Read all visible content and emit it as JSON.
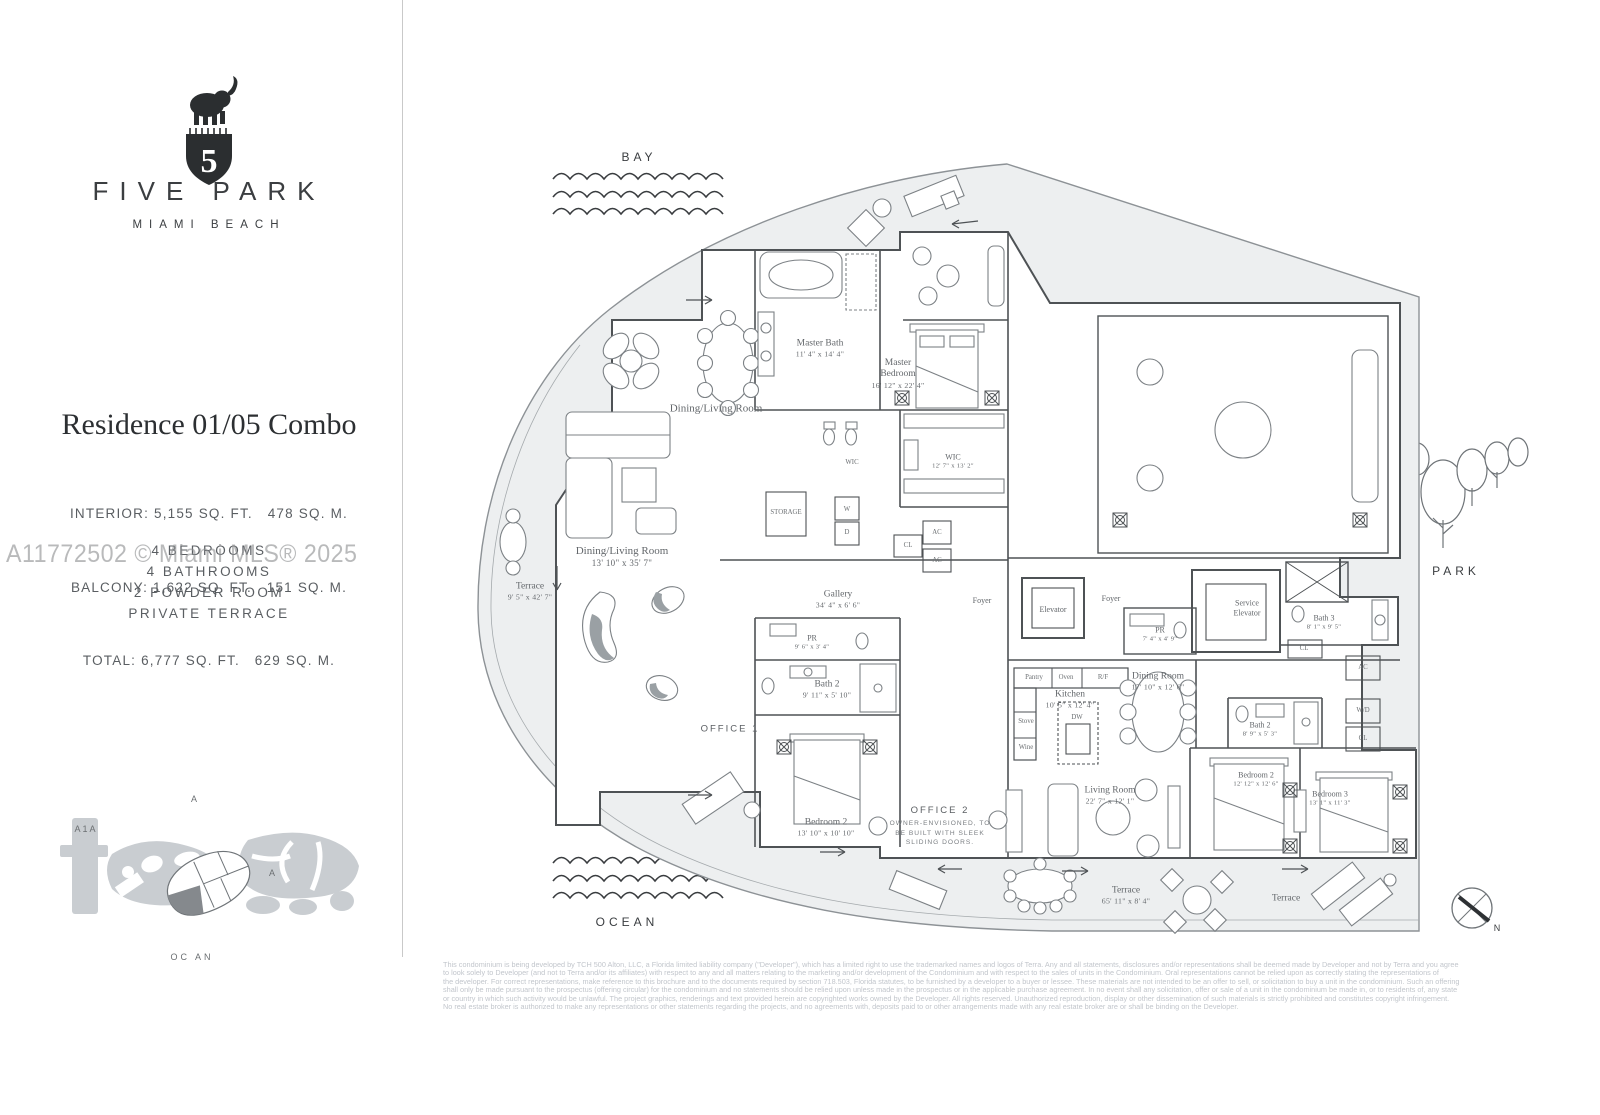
{
  "brand": {
    "logo": "elephant-on-shield-5",
    "name": "FIVE PARK",
    "location": "MIAMI BEACH"
  },
  "residence": {
    "title": "Residence 01/05 Combo",
    "stats": [
      "INTERIOR: 5,155 SQ. FT.   478 SQ. M.",
      "BALCONY: 1,622 SQ. FT.   151 SQ. M.",
      "TOTAL: 6,777 SQ. FT.   629 SQ. M."
    ],
    "features": [
      "4 BEDROOMS",
      "4 BATHROOMS",
      "2 POWDER ROOM",
      "PRIVATE TERRACE"
    ]
  },
  "watermark": "A11772502 © Miami MLS® 2025",
  "site_map": {
    "label_top": "A",
    "label_road": "A1A",
    "label_mid": "A",
    "label_bottom": "OC AN"
  },
  "surroundings": {
    "bay": "BAY",
    "ocean": "OCEAN",
    "park": "PARK",
    "north": "N"
  },
  "plan": {
    "rooms": [
      {
        "cls": "lg",
        "label": "Dining/Living Room",
        "x": 716,
        "y": 409
      },
      {
        "cls": "md",
        "label": "Master Bath",
        "dims": "11' 4\" x 14' 4\"",
        "x": 820,
        "y": 349
      },
      {
        "cls": "md",
        "label": "Master\nBedroom",
        "dims": "16' 12\" x 22' 4\"",
        "x": 898,
        "y": 374
      },
      {
        "cls": "box",
        "label": "WIC",
        "x": 852,
        "y": 463
      },
      {
        "cls": "sm",
        "label": "WIC",
        "dims": "12' 7\" x 13' 2\"",
        "x": 953,
        "y": 461
      },
      {
        "cls": "box",
        "label": "STORAGE",
        "x": 786,
        "y": 513
      },
      {
        "cls": "box",
        "label": "W",
        "x": 847,
        "y": 510
      },
      {
        "cls": "box",
        "label": "D",
        "x": 847,
        "y": 533
      },
      {
        "cls": "box",
        "label": "CL",
        "x": 908,
        "y": 546
      },
      {
        "cls": "box",
        "label": "AC",
        "x": 937,
        "y": 533
      },
      {
        "cls": "box",
        "label": "AC",
        "x": 937,
        "y": 561
      },
      {
        "cls": "md",
        "label": "Terrace",
        "dims": "9' 5\" x 42' 7\"",
        "x": 530,
        "y": 592
      },
      {
        "cls": "lg",
        "label": "Dining/Living Room",
        "dims": "13' 10\" x 35' 7\"",
        "x": 622,
        "y": 557
      },
      {
        "cls": "md",
        "label": "Gallery",
        "dims": "34' 4\" x 6' 6\"",
        "x": 838,
        "y": 600
      },
      {
        "cls": "sm",
        "label": "Foyer",
        "x": 982,
        "y": 601
      },
      {
        "cls": "sm",
        "label": "Elevator",
        "x": 1053,
        "y": 610
      },
      {
        "cls": "sm",
        "label": "Foyer",
        "x": 1111,
        "y": 599
      },
      {
        "cls": "sm",
        "label": "PR",
        "dims": "7' 4\" x 4' 9\"",
        "x": 1160,
        "y": 634
      },
      {
        "cls": "sm",
        "label": "Service\nElevator",
        "x": 1247,
        "y": 608
      },
      {
        "cls": "sm",
        "label": "Bath 3",
        "dims": "8' 1\" x 9' 5\"",
        "x": 1324,
        "y": 622
      },
      {
        "cls": "box",
        "label": "CL",
        "x": 1304,
        "y": 649
      },
      {
        "cls": "box",
        "label": "AC",
        "x": 1363,
        "y": 668
      },
      {
        "cls": "box",
        "label": "W/D",
        "x": 1363,
        "y": 711
      },
      {
        "cls": "box",
        "label": "CL",
        "x": 1363,
        "y": 739
      },
      {
        "cls": "box",
        "label": "Pantry",
        "x": 1034,
        "y": 678
      },
      {
        "cls": "box",
        "label": "Oven",
        "x": 1066,
        "y": 678
      },
      {
        "cls": "box",
        "label": "R/F",
        "x": 1103,
        "y": 678
      },
      {
        "cls": "md",
        "label": "Kitchen",
        "dims": "10' 5\" x 12' 4\"",
        "x": 1070,
        "y": 700
      },
      {
        "cls": "box",
        "label": "Stove",
        "x": 1026,
        "y": 722
      },
      {
        "cls": "box",
        "label": "Wine",
        "x": 1026,
        "y": 748
      },
      {
        "cls": "box",
        "label": "DW",
        "x": 1077,
        "y": 718
      },
      {
        "cls": "md",
        "label": "Dining Room",
        "dims": "17' 10\" x 12' 6\"",
        "x": 1158,
        "y": 682
      },
      {
        "cls": "sm",
        "label": "PR",
        "dims": "9' 6\" x 3' 4\"",
        "x": 812,
        "y": 642
      },
      {
        "cls": "md",
        "label": "Bath 2",
        "dims": "9' 11\" x 5' 10\"",
        "x": 827,
        "y": 690
      },
      {
        "cls": "caps",
        "label": "OFFICE 1",
        "x": 730,
        "y": 729
      },
      {
        "cls": "md",
        "label": "Bedroom 2",
        "dims": "13' 10\" x 10' 10\"",
        "x": 826,
        "y": 828
      },
      {
        "cls": "caps",
        "label": "OFFICE 2",
        "x": 940,
        "y": 826,
        "sub": "OWNER-ENVISIONED, TO\nBE BUILT WITH SLEEK\nSLIDING DOORS."
      },
      {
        "cls": "md",
        "label": "Living Room",
        "dims": "22' 7\" x 12' 1\"",
        "x": 1110,
        "y": 796
      },
      {
        "cls": "sm",
        "label": "Bath 2",
        "dims": "8' 9\" x 5' 3\"",
        "x": 1260,
        "y": 729
      },
      {
        "cls": "sm",
        "label": "Bedroom 2",
        "dims": "12' 12\" x 12' 6\"",
        "x": 1256,
        "y": 779
      },
      {
        "cls": "sm",
        "label": "Bedroom 3",
        "dims": "13' 1\" x 11' 3\"",
        "x": 1330,
        "y": 798
      },
      {
        "cls": "md",
        "label": "Terrace",
        "dims": "65' 11\" x 8' 4\"",
        "x": 1126,
        "y": 896
      },
      {
        "cls": "md",
        "label": "Terrace",
        "x": 1286,
        "y": 899
      }
    ]
  },
  "disclaimer": "This condominium is being developed by TCH 500 Alton, LLC, a Florida limited liability company (\"Developer\"), which has a limited right to use the trademarked names and logos of Terra. Any and all statements, disclosures and/or representations shall be deemed made by Developer and not by Terra and you agree\nto look solely to Developer (and not to Terra and/or its affiliates) with respect to any and all matters relating to the marketing and/or development of the Condominium and with respect to the sales of units in the Condominium. Oral representations cannot be relied upon as correctly stating the representations of\nthe developer. For correct representations, make reference to this brochure and to the documents required by section 718.503, Florida statutes, to be furnished by a developer to a buyer or lessee. These materials are not intended to be an offer to sell, or solicitation to buy a unit in the condominium. Such an offering\nshall only be made pursuant to the prospectus (offering circular) for the condominium and no statements should be relied upon unless made in the prospectus or in the applicable purchase agreement. In no event shall any solicitation, offer or sale of a unit in the condominium be made in, or to residents of, any state\nor country in which such activity would be unlawful. The project graphics, renderings and text provided herein are copyrighted works owned by the Developer. All rights reserved. Unauthorized reproduction, display or other dissemination of such materials is strictly prohibited and constitutes copyright infringement.\nNo real estate broker is authorized to make any representations or other statements regarding the projects, and no agreements with, deposits paid to or other arrangements made with any real estate broker are or shall be binding on the Developer.",
  "colors": {
    "wall": "#4e5255",
    "terrace_fill": "#edeff0",
    "accent_dark": "#2e3134",
    "site_gray": "#c9cdd1",
    "label_gray": "#63676b",
    "watermark_gray": "#8f9193"
  }
}
